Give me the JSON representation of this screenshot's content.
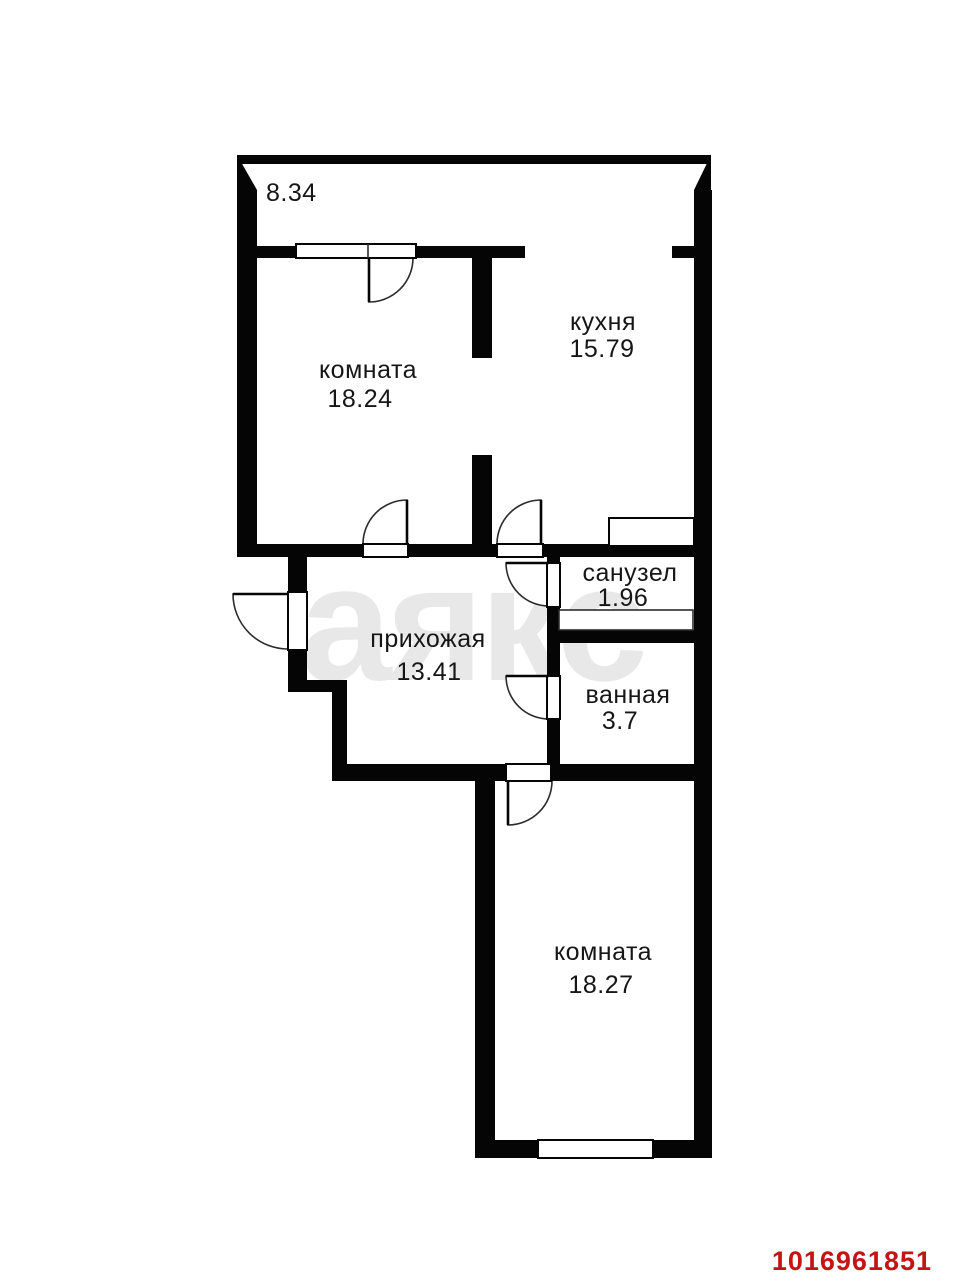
{
  "watermark": {
    "text": "аякс"
  },
  "footer": {
    "plan_id": "1016961851"
  },
  "rooms": {
    "balcony": {
      "area": "8.34"
    },
    "room1": {
      "name": "комната",
      "area": "18.24"
    },
    "kitchen": {
      "name": "кухня",
      "area": "15.79"
    },
    "hall": {
      "name": "прихожая",
      "area": "13.41"
    },
    "wc": {
      "name": "санузел",
      "area": "1.96"
    },
    "bath": {
      "name": "ванная",
      "area": "3.7"
    },
    "room2": {
      "name": "комната",
      "area": "18.27"
    }
  },
  "colors": {
    "wall": "#050505",
    "floor": "#ffffff",
    "watermark": "#e8e8e8",
    "stroke": "#2b2b2b",
    "plan-id": "#c41414"
  }
}
